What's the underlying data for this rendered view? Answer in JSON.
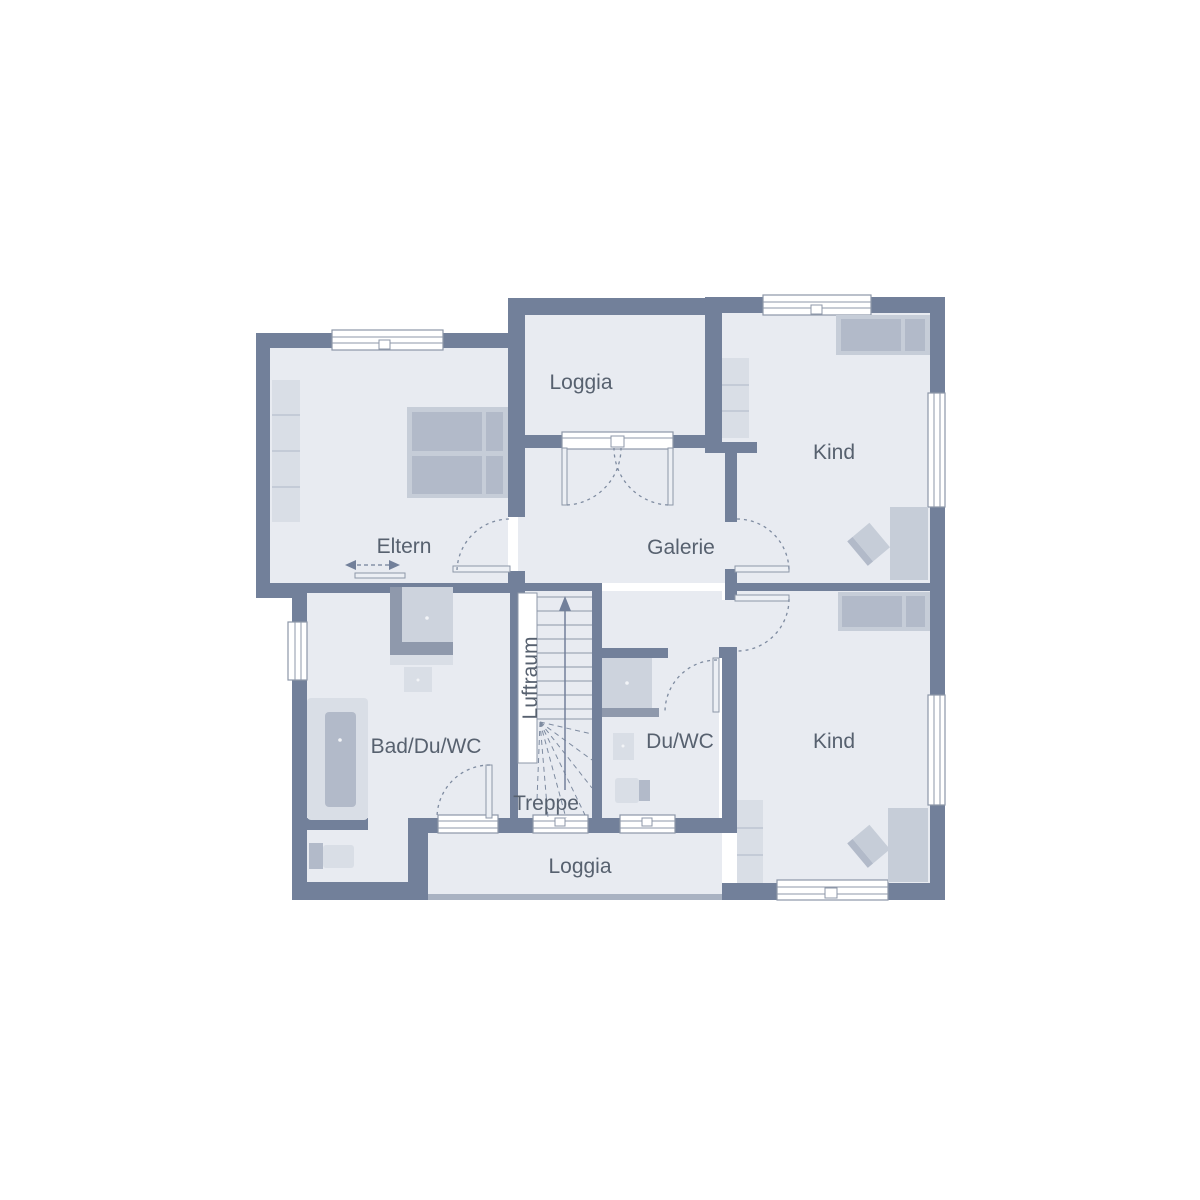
{
  "rooms": {
    "loggia_top": {
      "label": "Loggia"
    },
    "kind_top": {
      "label": "Kind"
    },
    "eltern": {
      "label": "Eltern"
    },
    "galerie": {
      "label": "Galerie"
    },
    "luftraum": {
      "label": "Luftraum"
    },
    "bad": {
      "label": "Bad/Du/WC"
    },
    "treppe": {
      "label": "Treppe"
    },
    "du_wc": {
      "label": "Du/WC"
    },
    "kind_bottom": {
      "label": "Kind"
    },
    "loggia_bottom": {
      "label": "Loggia"
    }
  },
  "colors": {
    "background": "#ffffff",
    "wall": "#72809a",
    "floor": "#e8ebf1",
    "outline": "#8d97a8",
    "furniture_light": "#d9dee6",
    "furniture_mid": "#c6cdd8",
    "furniture_dark": "#b2bac9",
    "fixture_frame": "#8f99ac",
    "fixture_fill": "#cdd3dd",
    "label_text": "#57616f",
    "parapet": "#a9b2c2"
  }
}
